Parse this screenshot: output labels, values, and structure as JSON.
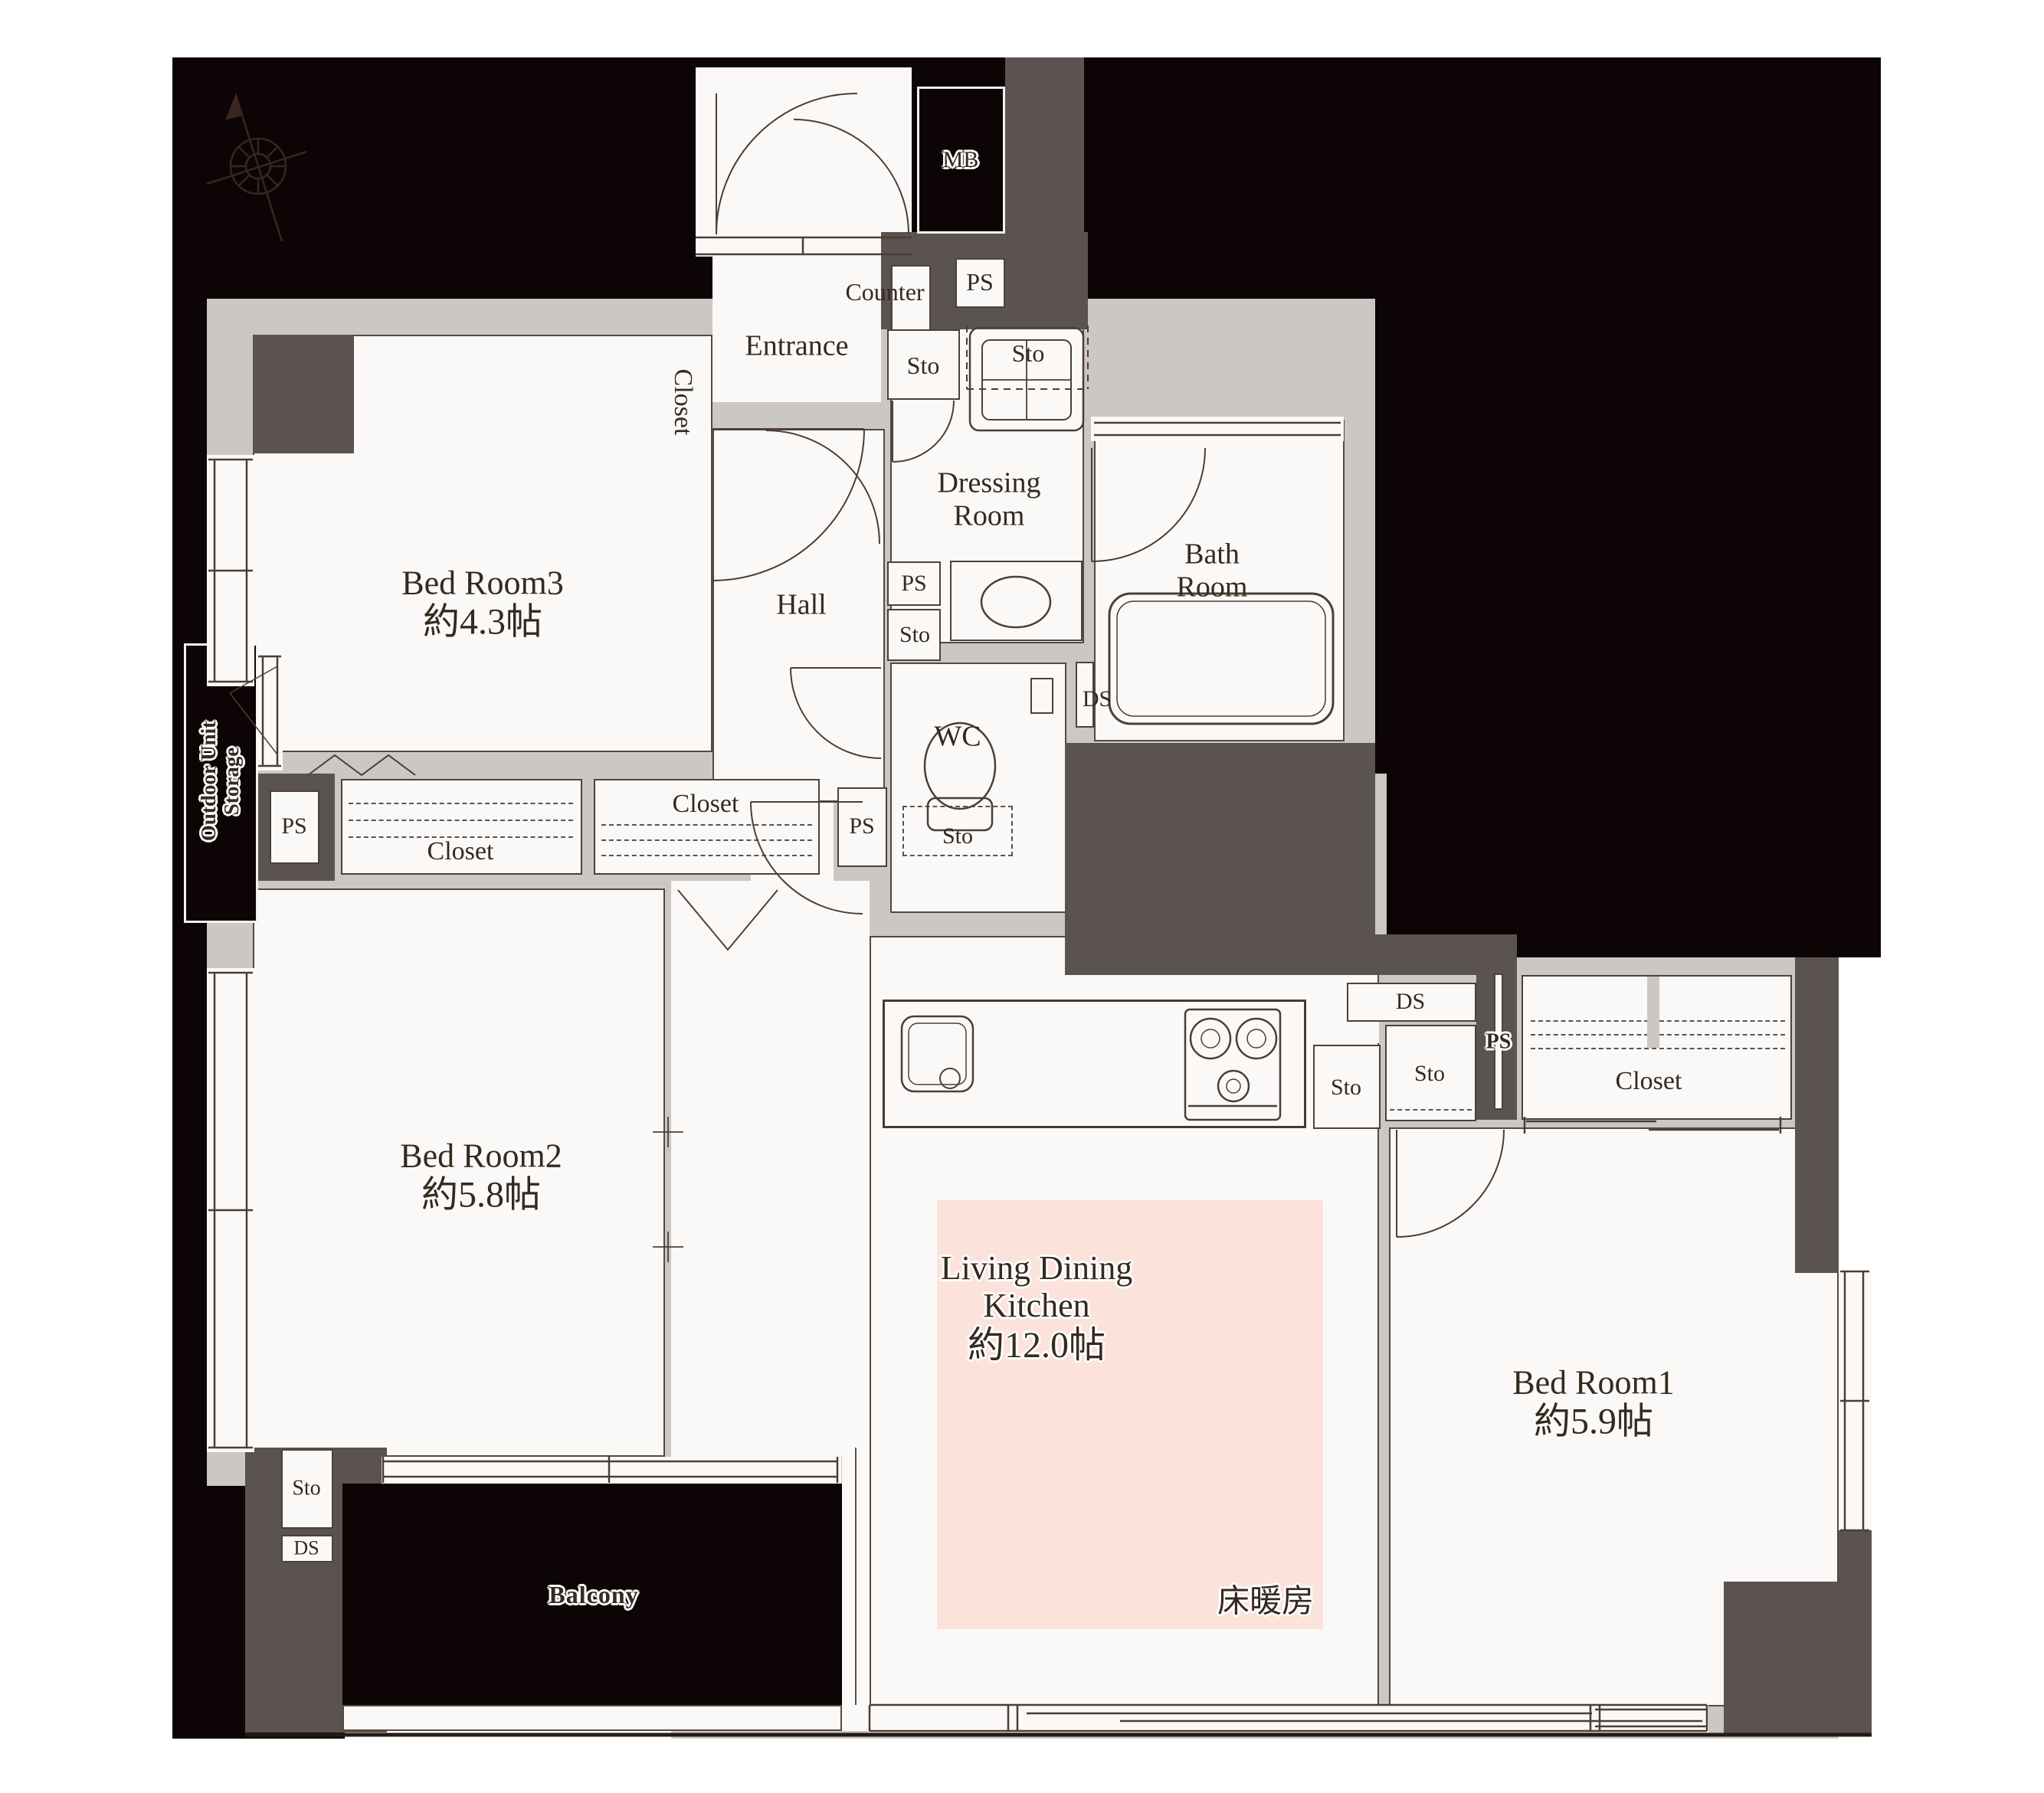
{
  "plan": {
    "type": "apartment floor plan",
    "rooms": {
      "bedroom1": {
        "name": "Bed Room1",
        "size": "約5.9帖"
      },
      "bedroom2": {
        "name": "Bed Room2",
        "size": "約5.8帖"
      },
      "bedroom3": {
        "name": "Bed Room3",
        "size": "約4.3帖"
      },
      "ldk": {
        "name_line1": "Living Dining",
        "name_line2": "Kitchen",
        "size": "約12.0帖",
        "floor_heating": "床暖房"
      }
    },
    "labels": {
      "entrance": "Entrance",
      "hall": "Hall",
      "counter": "Counter",
      "dressing_room": "Dressing Room",
      "bath_room": "Bath Room",
      "wc": "WC",
      "balcony": "Balcony",
      "mb": "MB",
      "outdoor_unit_storage_line1": "Outdoor Unit",
      "outdoor_unit_storage_line2": "Storage",
      "closet": "Closet",
      "sto": "Sto",
      "ps": "PS",
      "ds": "DS"
    },
    "colors": {
      "outside_black": "#0c0405",
      "structure_wall": "#5a5350",
      "interior_wall": "#cac7c4",
      "floor": "#fbf9f7",
      "floor_heating_pink": "#fbe3dc",
      "line": "#4c3e36"
    }
  }
}
